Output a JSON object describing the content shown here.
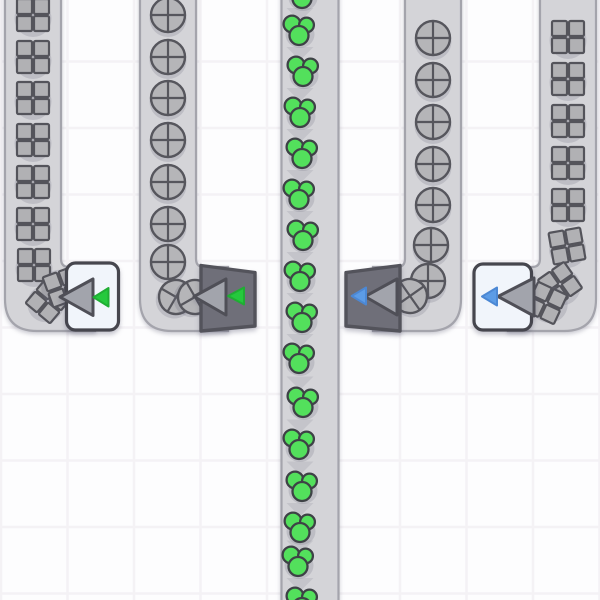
{
  "app": {
    "name": "conveyor-factory-game",
    "view": "belt-network"
  },
  "scene": {
    "width": 600,
    "height": 600,
    "background": "#fdfdfe",
    "grid": {
      "spacing": 66.5,
      "offset_x": 1,
      "offset_y": 61.5,
      "line_color": "#f4f2f5",
      "line_width": 2.5
    },
    "palette": {
      "belt_fill": "#d4d4d8",
      "belt_border": "#a4a4ac",
      "chevron": "#c4c4ca",
      "item_square_fill": "#b1b1b4",
      "item_square_outline": "#54545b",
      "item_circle_fill": "#b5b5b8",
      "item_circle_outline": "#56565d",
      "blob_fill": "#53e05c",
      "blob_outline": "#3e4246",
      "item_shadow": "rgba(108,108,126,0.22)",
      "box_fill": "#f1f5fb",
      "box_border": "#46464e",
      "trapezoid_fill": "#6f6f79",
      "trapezoid_border": "#53535b",
      "arrow_fill": "#a2a4ac",
      "arrow_outline": "#4f4f57",
      "green": "#25c93d",
      "green_outline": "#1fae33",
      "blue": "#5c9ce6",
      "blue_outline": "#4c88d4"
    },
    "belts": [
      {
        "id": "belt-1-squares-left",
        "item_type": "square",
        "shape": "curve-right",
        "x": 5,
        "width": 56,
        "h_top": 267,
        "h_bottom": 331,
        "h_end": 95,
        "items": [
          [
            33,
            15,
            0
          ],
          [
            33,
            57,
            0
          ],
          [
            33,
            98,
            0
          ],
          [
            33,
            140,
            0
          ],
          [
            33,
            182,
            0
          ],
          [
            33,
            224,
            0
          ],
          [
            34,
            265,
            0
          ],
          [
            48,
            301,
            40
          ],
          [
            63,
            287,
            70
          ]
        ]
      },
      {
        "id": "belt-2-circles-left",
        "item_type": "circle",
        "shape": "curve-right",
        "x": 140,
        "width": 56,
        "h_top": 267,
        "h_bottom": 331,
        "h_end": 228,
        "items": [
          [
            168,
            15,
            0
          ],
          [
            168,
            57,
            0
          ],
          [
            168,
            98,
            0
          ],
          [
            168,
            140,
            0
          ],
          [
            168,
            182,
            0
          ],
          [
            168,
            224,
            0
          ],
          [
            168,
            262,
            0
          ],
          [
            176,
            297,
            30
          ],
          [
            195,
            297,
            60
          ]
        ]
      },
      {
        "id": "belt-3-center-green",
        "item_type": "blob",
        "shape": "straight",
        "x": 281.5,
        "width": 57,
        "arrows": [
          [
            300,
            14.5
          ],
          [
            300,
            53.5
          ],
          [
            300,
            94.5
          ],
          [
            300,
            135.5
          ],
          [
            300,
            176.5
          ],
          [
            300,
            217.5
          ],
          [
            300,
            258.5
          ],
          [
            300,
            299.5
          ],
          [
            300,
            340.5
          ],
          [
            300,
            383
          ],
          [
            300,
            426
          ],
          [
            300,
            468
          ],
          [
            300,
            509.5
          ],
          [
            300,
            547
          ],
          [
            300,
            584.5
          ]
        ],
        "items": [
          [
            303,
            -6,
            0
          ],
          [
            300,
            31,
            0
          ],
          [
            304,
            72,
            0
          ],
          [
            301,
            113,
            0
          ],
          [
            303,
            154,
            0
          ],
          [
            300,
            195,
            0
          ],
          [
            304,
            236,
            0
          ],
          [
            301,
            277,
            0
          ],
          [
            303,
            318,
            0
          ],
          [
            300,
            359,
            0
          ],
          [
            304,
            403,
            0
          ],
          [
            300,
            445,
            0
          ],
          [
            303,
            487,
            0
          ],
          [
            301,
            528,
            0
          ],
          [
            299,
            562,
            0
          ],
          [
            303,
            603,
            0
          ]
        ]
      },
      {
        "id": "belt-4-circles-right",
        "item_type": "circle",
        "shape": "curve-left",
        "x": 405,
        "width": 56,
        "h_top": 267,
        "h_bottom": 331,
        "h_end": 373,
        "items": [
          [
            433,
            38,
            0
          ],
          [
            433,
            80,
            0
          ],
          [
            433,
            122,
            0
          ],
          [
            433,
            164,
            0
          ],
          [
            433,
            205,
            0
          ],
          [
            431,
            245,
            0
          ],
          [
            428,
            281,
            0
          ],
          [
            410,
            296,
            -35
          ]
        ]
      },
      {
        "id": "belt-5-squares-right",
        "item_type": "square",
        "shape": "curve-left",
        "x": 540,
        "width": 56,
        "h_top": 267,
        "h_bottom": 331,
        "h_end": 508,
        "items": [
          [
            568,
            37,
            0
          ],
          [
            568,
            79,
            0
          ],
          [
            568,
            121,
            0
          ],
          [
            568,
            163,
            0
          ],
          [
            568,
            205,
            0
          ],
          [
            567,
            246,
            -10
          ],
          [
            560,
            284,
            -35
          ],
          [
            546,
            303,
            -65
          ]
        ]
      }
    ],
    "devices": [
      {
        "id": "device-1-box-green",
        "body": "box",
        "rect": [
          66.5,
          263,
          52,
          67
        ],
        "arrow": {
          "tip": [
            60,
            297
          ],
          "base_x": 93,
          "y1": 279,
          "y2": 315.5
        },
        "filter": {
          "color_key": "green",
          "tip": [
            93.5,
            297.3
          ],
          "base_x": 108.5,
          "y1": 288,
          "y2": 306.5
        }
      },
      {
        "id": "device-2-trapezoid-green",
        "body": "trapezoid",
        "x1": 201,
        "x2": 255,
        "left_y": [
          265.5,
          331
        ],
        "right_y": [
          272.5,
          326
        ],
        "arrow": {
          "tip": [
            194,
            296.5
          ],
          "base_x": 226,
          "y1": 279,
          "y2": 315
        },
        "filter": {
          "color_key": "green",
          "tip": [
            228,
            296
          ],
          "base_x": 244,
          "y1": 287.5,
          "y2": 304.5
        }
      },
      {
        "id": "device-3-trapezoid-blue",
        "body": "trapezoid",
        "x1": 346,
        "x2": 400,
        "left_y": [
          272.5,
          326
        ],
        "right_y": [
          265.5,
          331
        ],
        "arrow": {
          "tip": [
            365,
            296.5
          ],
          "base_x": 397,
          "y1": 279,
          "y2": 315
        },
        "filter": {
          "color_key": "blue",
          "tip": [
            351.7,
            296
          ],
          "base_x": 366,
          "y1": 287.5,
          "y2": 304.5
        }
      },
      {
        "id": "device-4-box-blue",
        "body": "box",
        "rect": [
          474,
          264,
          57.5,
          66
        ],
        "arrow": {
          "tip": [
            498,
            296.5
          ],
          "base_x": 534,
          "y1": 278,
          "y2": 316
        },
        "filter": {
          "color_key": "blue",
          "tip": [
            482,
            296.5
          ],
          "base_x": 497,
          "y1": 287.5,
          "y2": 305.5
        }
      }
    ]
  }
}
